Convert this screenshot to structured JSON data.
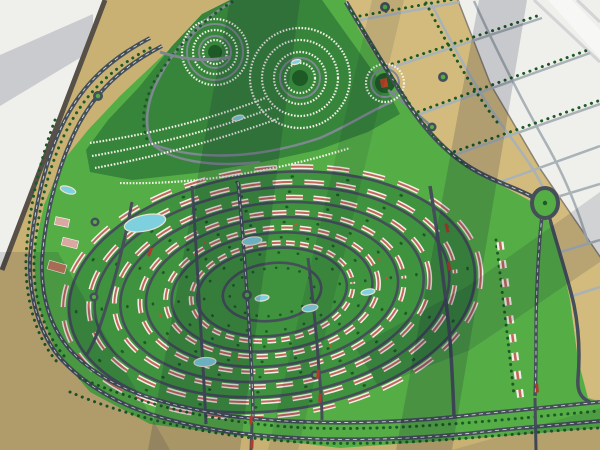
{
  "scene": {
    "description": "Aerial photograph of a large architectural scale model of a master-planned residential community: concentric oval rings of white red-roofed housing rows on green lawns, a circular villa cluster at the top, golden desert plots on the right, a tree-lined boulevard along the bottom, swimming pools and roundabouts, displayed on a table over a white showroom floor with diagonal window shadows.",
    "width": 600,
    "height": 450
  },
  "palette": {
    "floor": "#efefec",
    "shadow": "#0a1230",
    "table_edge": "#575046",
    "sand": "#c9b173",
    "sand_bright": "#d2bb7d",
    "lawn_bright": "#55ad46",
    "ring_green": "#3f923e",
    "cluster_green": "#37853a",
    "road_dark": "#454f59",
    "road_mid": "#7e8890",
    "road_light": "#a9b2b7",
    "dash": "#f2f2ee",
    "building": "#f4f1e8",
    "roof": "#c0685a",
    "tree": "#1d5a26",
    "flame": "#c2562e",
    "pool": "#7fd0df",
    "pool_deck": "#e9e4d3",
    "accent_red": "#b03a2e",
    "amenity_pink": "#d9a8a0",
    "amenity_brick": "#c07a58",
    "landmark_red": "#b04326"
  },
  "community": {
    "cx": 272,
    "cy": 292,
    "rx": 206,
    "ry": 120,
    "rotation": -7,
    "ring_fractions": [
      0.99,
      0.865,
      0.74,
      0.615,
      0.49,
      0.365,
      0.24
    ],
    "tree_ring_offset": 7,
    "building_ring_offset": 6
  },
  "pools": [
    {
      "x": 145,
      "y": 223,
      "rx": 21,
      "ry": 8,
      "rot": -12
    },
    {
      "x": 252,
      "y": 241,
      "rx": 10,
      "ry": 4,
      "rot": -8
    },
    {
      "x": 205,
      "y": 362,
      "rx": 11,
      "ry": 4.5,
      "rot": -4
    },
    {
      "x": 310,
      "y": 308,
      "rx": 8,
      "ry": 3.5,
      "rot": -10
    },
    {
      "x": 368,
      "y": 292,
      "rx": 7,
      "ry": 3,
      "rot": -10
    },
    {
      "x": 68,
      "y": 190,
      "rx": 8,
      "ry": 3.5,
      "rot": 18
    },
    {
      "x": 238,
      "y": 118,
      "rx": 6,
      "ry": 2.5,
      "rot": -15
    },
    {
      "x": 296,
      "y": 62,
      "rx": 5,
      "ry": 2.2,
      "rot": -15
    },
    {
      "x": 262,
      "y": 298,
      "rx": 7,
      "ry": 3,
      "rot": -8
    }
  ],
  "roundabouts": [
    {
      "x": 98,
      "y": 96,
      "r": 5
    },
    {
      "x": 385,
      "y": 7,
      "r": 5
    },
    {
      "x": 443,
      "y": 77,
      "r": 5
    },
    {
      "x": 432,
      "y": 127,
      "r": 4.5
    },
    {
      "x": 95,
      "y": 222,
      "r": 4.5
    },
    {
      "x": 94,
      "y": 297,
      "r": 4.5
    },
    {
      "x": 247,
      "y": 295,
      "r": 5
    },
    {
      "x": 315,
      "y": 375,
      "r": 4.5
    }
  ],
  "oval_roundabout": {
    "x": 545,
    "y": 203,
    "rx": 13,
    "ry": 15
  },
  "red_medians": [
    {
      "x": 251,
      "y": 420,
      "rot": 2
    },
    {
      "x": 252,
      "y": 444,
      "rot": 2
    },
    {
      "x": 318,
      "y": 374,
      "rot": 4
    },
    {
      "x": 320,
      "y": 398,
      "rot": 4
    },
    {
      "x": 447,
      "y": 228,
      "rot": -15
    },
    {
      "x": 449,
      "y": 266,
      "rot": -10
    },
    {
      "x": 537,
      "y": 388,
      "rot": -5
    },
    {
      "x": 150,
      "y": 252,
      "rot": 20
    }
  ],
  "lawn_column": {
    "x1": 500,
    "y1": 242,
    "x2": 522,
    "y2": 408,
    "block": 8,
    "gap": 10.6
  },
  "amenities": [
    {
      "x": 62,
      "y": 222,
      "w": 14,
      "h": 8,
      "rot": 12,
      "fill_key": "amenity_pink"
    },
    {
      "x": 70,
      "y": 243,
      "w": 16,
      "h": 8,
      "rot": 14,
      "fill_key": "amenity_pink"
    },
    {
      "x": 57,
      "y": 267,
      "w": 18,
      "h": 9,
      "rot": 16,
      "fill_key": "amenity_brick"
    }
  ],
  "landmark": {
    "x": 384,
    "y": 83,
    "w": 7,
    "h": 9,
    "rot": -12
  }
}
